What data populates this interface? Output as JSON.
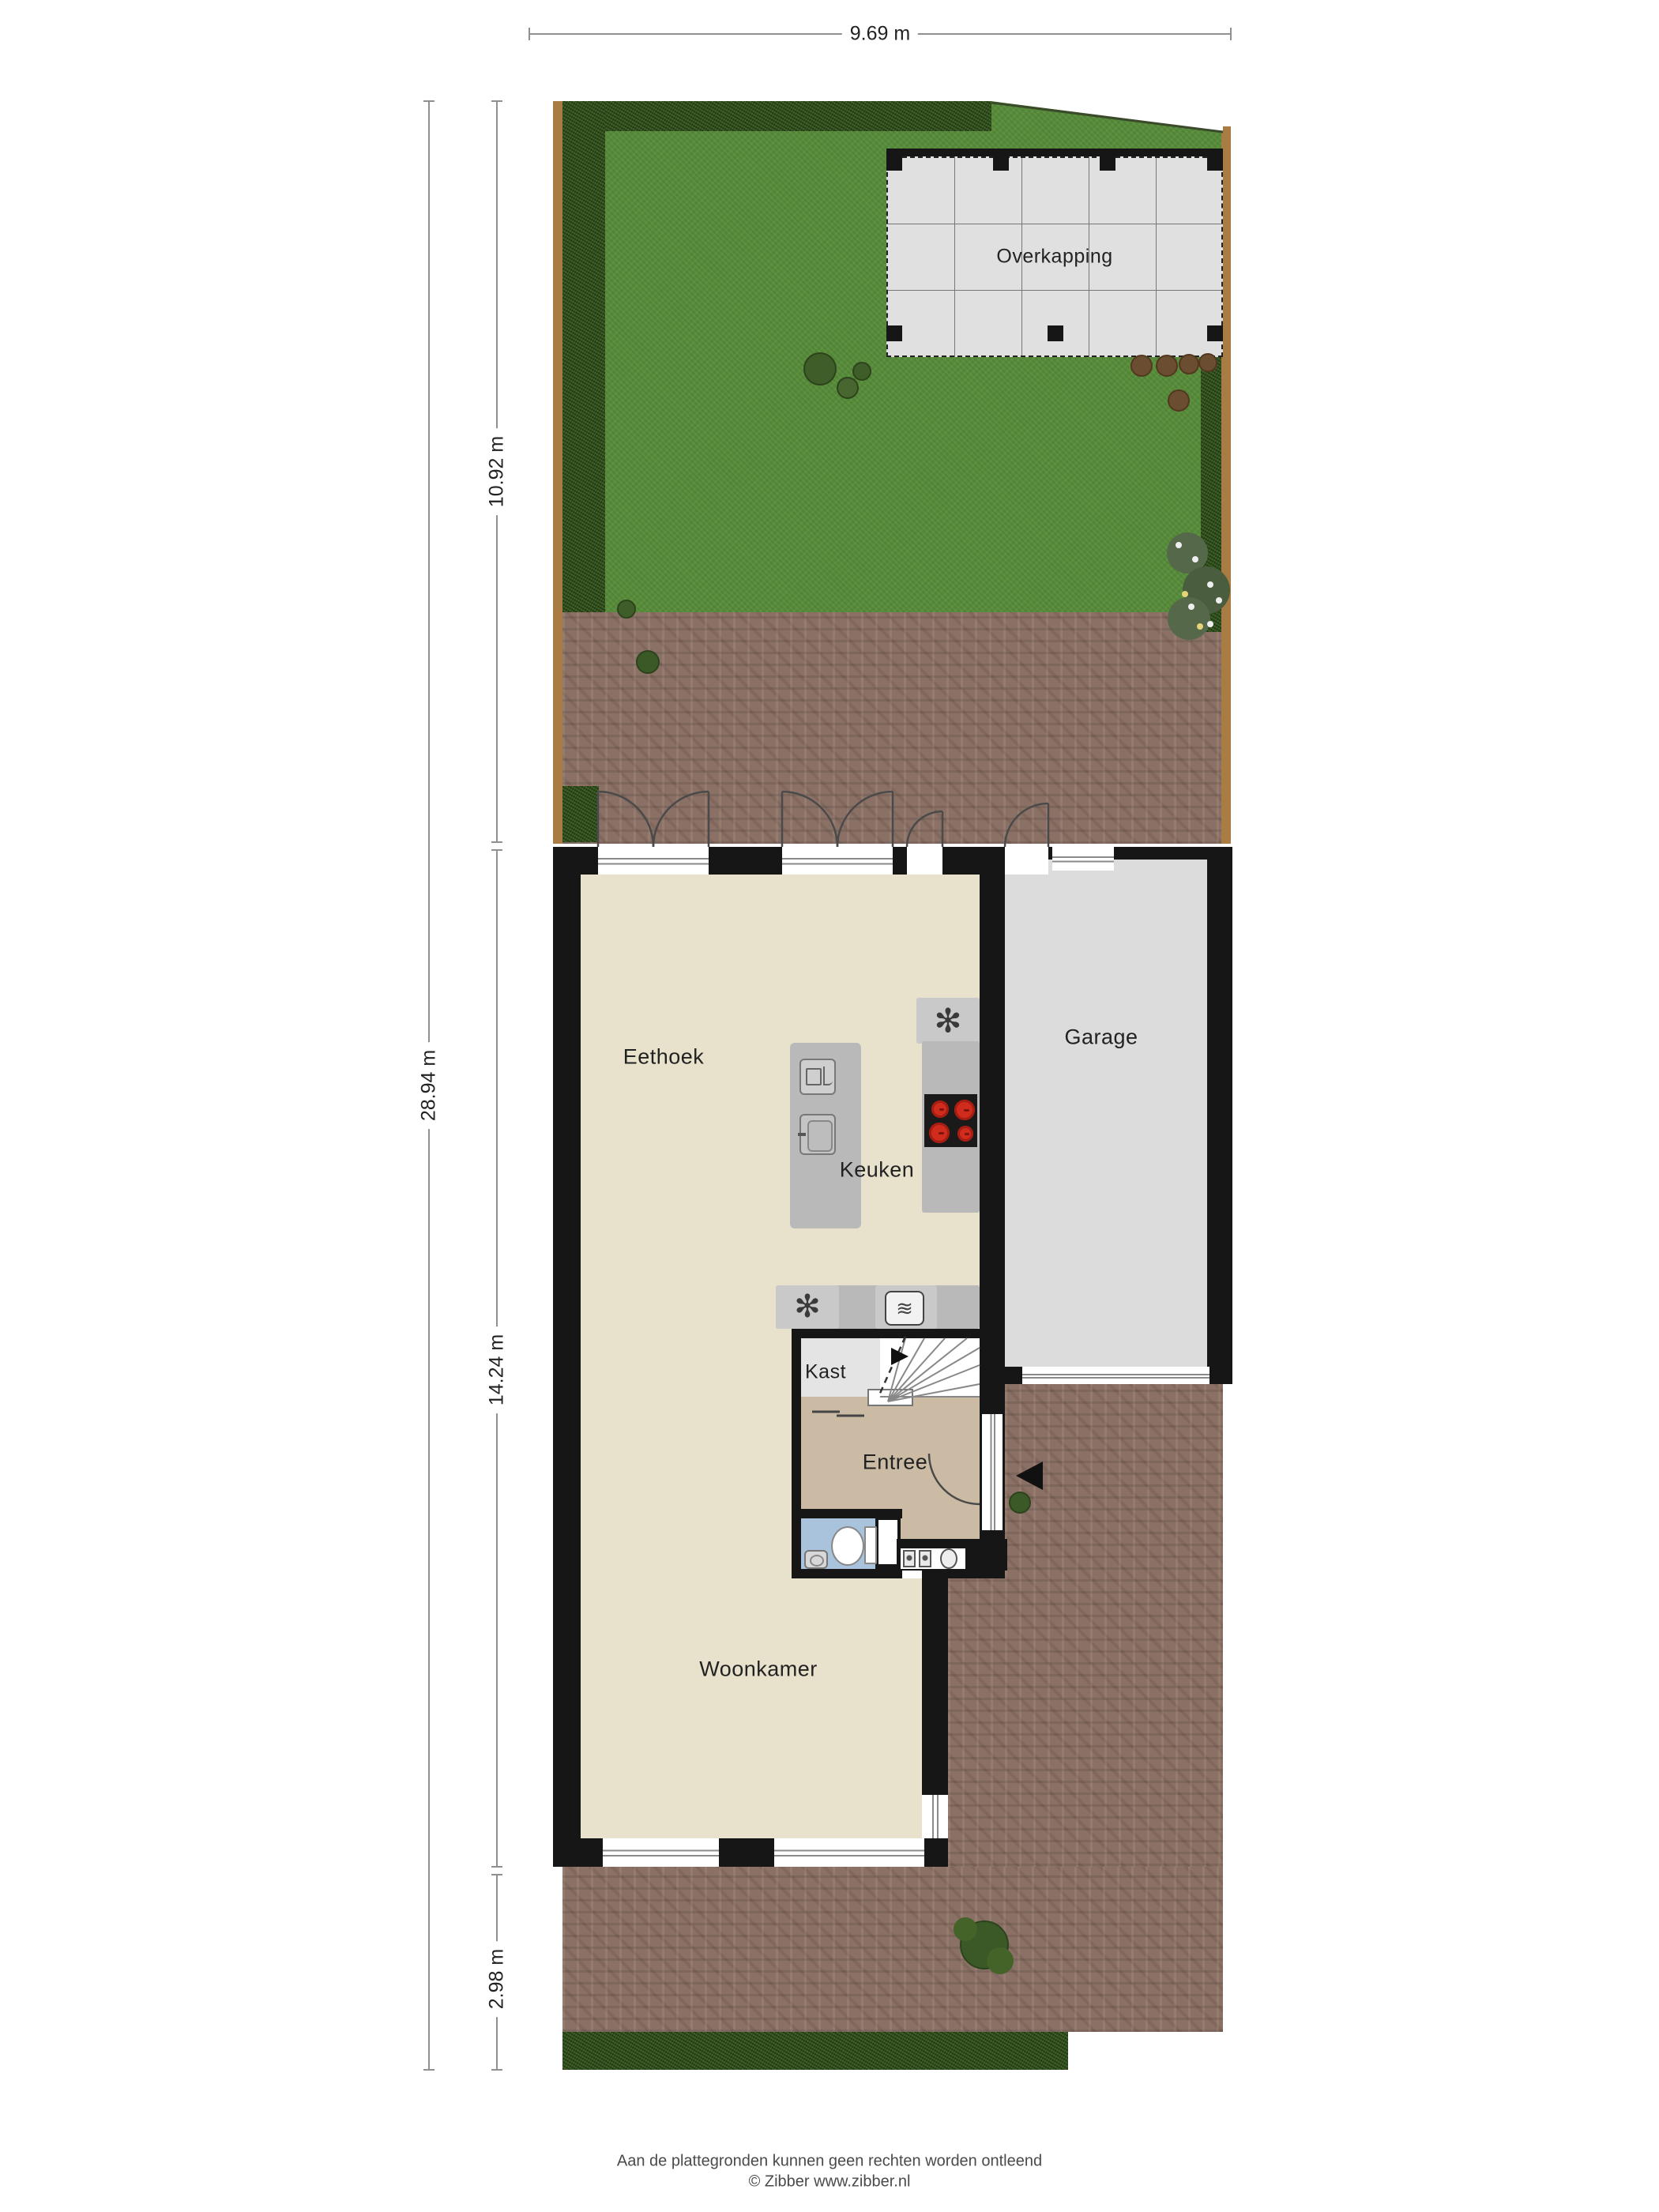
{
  "plan": {
    "rooms": {
      "overkapping": "Overkapping",
      "eethoek": "Eethoek",
      "keuken": "Keuken",
      "garage": "Garage",
      "kast": "Kast",
      "entree": "Entree",
      "woonkamer": "Woonkamer"
    },
    "dimensions": {
      "top_width": "9.69 m",
      "garden_depth": "10.92 m",
      "total_depth": "28.94 m",
      "house_depth": "14.24 m",
      "front_depth": "2.98 m"
    },
    "icons": {
      "extractor": "✻",
      "oven": "≋"
    },
    "footer": {
      "disclaimer": "Aan de plattegronden kunnen geen rechten worden ontleend",
      "copyright": "© Zibber www.zibber.nl"
    },
    "colors": {
      "wall": "#161616",
      "grass": "#578c3a",
      "hedge": "#33531f",
      "fence": "#a87c42",
      "brick": "#8b7165",
      "living_floor": "#e8e1cb",
      "entree_floor": "#cbbba5",
      "kast_floor": "#e4e4e4",
      "garage_floor": "#dcdcdc",
      "toilet_floor": "#a9c3dc",
      "counter": "#b9b9b9",
      "overkapping": "#e0e0e0",
      "burner_red": "#cf2c1e"
    }
  }
}
